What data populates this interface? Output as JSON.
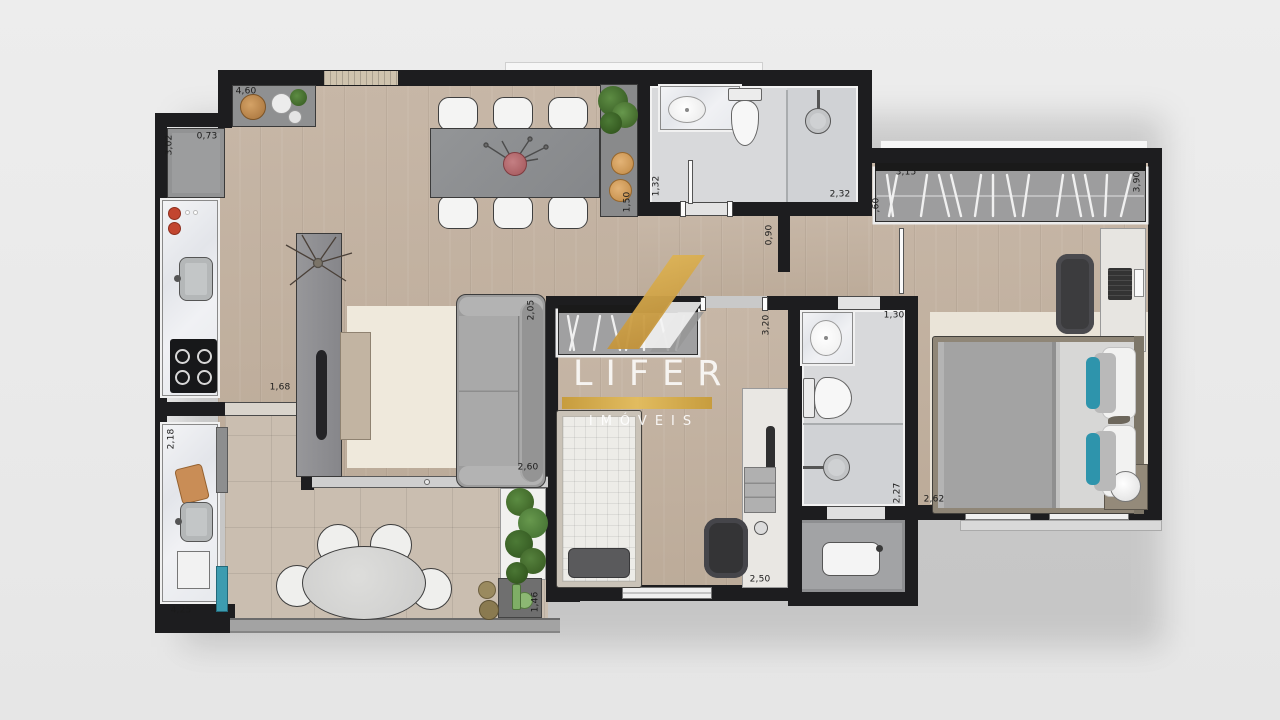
{
  "watermark": {
    "brand": "LIFER",
    "subtitle": "IMÓVEIS",
    "brand_gold": "#d2a43c"
  },
  "colors": {
    "accent_teal": "#2f96ad",
    "wall": "#1d1d1f"
  },
  "measurements": {
    "kitchen": {
      "top_wall": "4,60",
      "cabinet_width": "0,73",
      "left_wall": "3,02",
      "balcony_door": "1,68"
    },
    "balcony": {
      "counter": "2,18",
      "length": "4,25",
      "garden": "1,46"
    },
    "living": {
      "hall_width": "1,50",
      "sofa_depth": "2,05",
      "sofa_length": "2,60"
    },
    "bathroom1": {
      "depth": "1,32",
      "width": "2,32"
    },
    "corridor": {
      "door": "0,90"
    },
    "bedroom2": {
      "depth": "3,20",
      "width": "2,50"
    },
    "bathroom2": {
      "width": "1,30",
      "shower_depth": "2,27"
    },
    "master": {
      "wardrobe_length": "3,15",
      "room_depth": "3,90",
      "wardrobe_depth": ",60",
      "window_wall": "2,62"
    }
  }
}
